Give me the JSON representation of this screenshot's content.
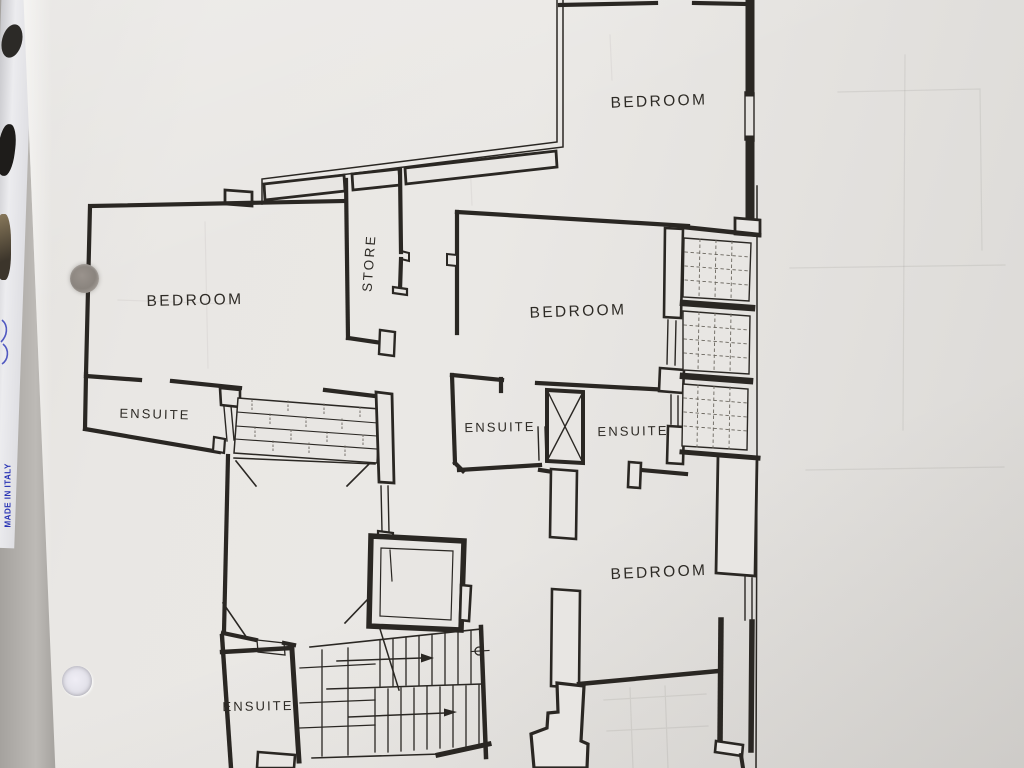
{
  "photo": {
    "edge_text": "MADE IN ITALY"
  },
  "colors": {
    "paper": "#e8e6e3",
    "ink": "#2a2723",
    "edge_text_blue": "#2a35b5",
    "background_gray": "#b4b1ad",
    "binder_strip_dark": "#4a463c"
  },
  "floor_plan": {
    "labels": [
      {
        "id": "bedroom-top",
        "text": "BEDROOM"
      },
      {
        "id": "bedroom-left",
        "text": "BEDROOM"
      },
      {
        "id": "bedroom-middle",
        "text": "BEDROOM"
      },
      {
        "id": "bedroom-bottom",
        "text": "BEDROOM"
      },
      {
        "id": "store",
        "text": "STORE"
      },
      {
        "id": "ensuite-left",
        "text": "ENSUITE"
      },
      {
        "id": "ensuite-center",
        "text": "ENSUITE"
      },
      {
        "id": "ensuite-right",
        "text": "ENSUITE"
      },
      {
        "id": "ensuite-bottom",
        "text": "ENSUITE"
      }
    ]
  }
}
